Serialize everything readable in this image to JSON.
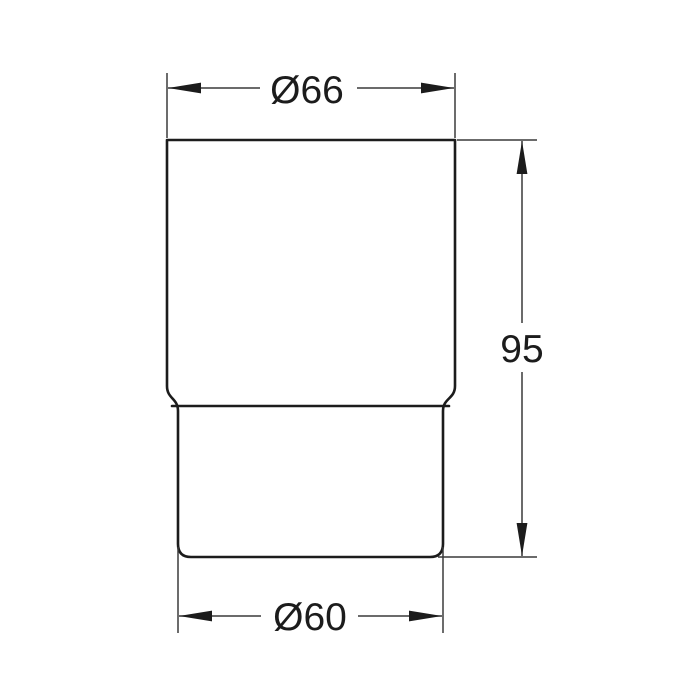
{
  "drawing": {
    "object_name": "tumbler-profile",
    "colors": {
      "background": "#ffffff",
      "outline": "#1c1c1c",
      "dimension": "#3a3a3a",
      "text": "#1c1c1c"
    },
    "dimensions": {
      "top_diameter": "Ø66",
      "height": "95",
      "bottom_diameter": "Ø60"
    }
  }
}
